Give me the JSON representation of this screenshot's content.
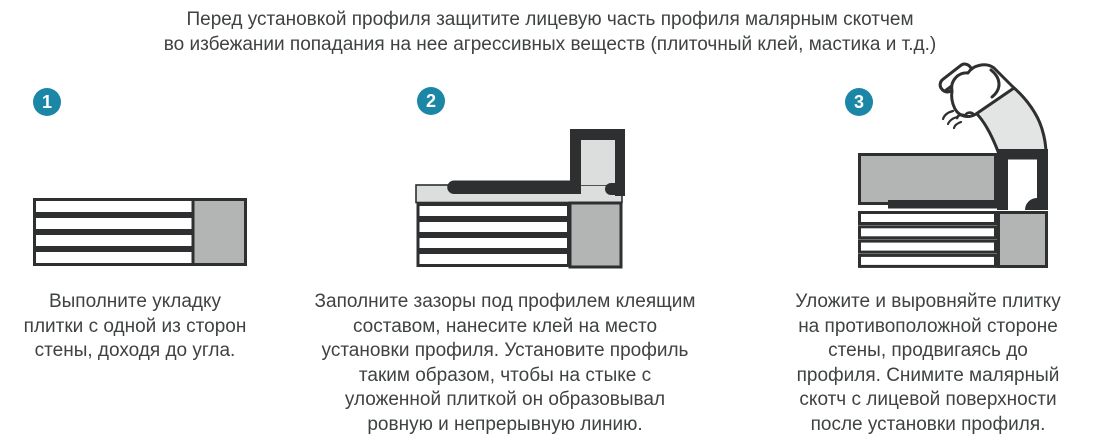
{
  "header": {
    "line1": "Перед установкой профиля защитите лицевую часть профиля малярным скотчем",
    "line2": "во избежании попадания на нее агрессивных веществ (плиточный клей, мастика и т.д.)"
  },
  "steps": [
    {
      "number": "1",
      "caption_lines": [
        "Выполните укладку",
        "плитки с одной из сторон",
        "стены, доходя до угла."
      ]
    },
    {
      "number": "2",
      "caption_lines": [
        "Заполните зазоры под профилем клеящим",
        "составом, нанесите клей на место",
        "установки профиля. Установите профиль",
        "таким образом, чтобы на стыке с",
        "уложенной плиткой он образовывал",
        "ровную и непрерывную линию."
      ]
    },
    {
      "number": "3",
      "caption_lines": [
        "Уложите и выровняйте плитку",
        "на противоположной стороне",
        "стены, продвигаясь до",
        "профиля. Снимите малярный",
        "скотч с лицевой поверхности",
        "после установки профиля."
      ]
    }
  ],
  "icons": {
    "step3_hand": "hand-peeling-masking-tape-icon"
  },
  "colors": {
    "badge_teal": "#1b86a6",
    "outline_dark": "#2d2f30",
    "tile_gray": "#b3b5b5",
    "adhesive_light_gray": "#dcdedd",
    "tape_light_gray": "#e3e4e4",
    "text_dark": "#3f4243",
    "background": "#ffffff"
  }
}
